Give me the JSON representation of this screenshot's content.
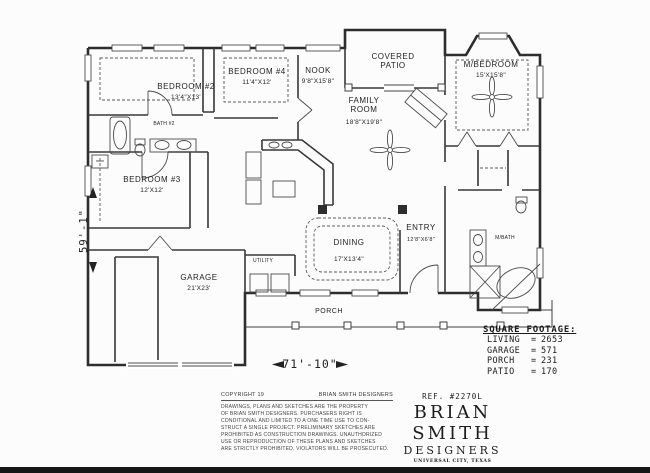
{
  "colors": {
    "paper": "#fcfcfc",
    "line": "#2d2d2d",
    "ink": "#1c1c1c"
  },
  "rooms": {
    "bedroom2": {
      "name": "BEDROOM #2",
      "size": "13'4\"X13'"
    },
    "bedroom4": {
      "name": "BEDROOM #4",
      "size": "11'4\"X12'"
    },
    "nook": {
      "name": "NOOK",
      "size": "9'8\"X15'8\""
    },
    "covered_patio": {
      "name": "COVERED PATIO"
    },
    "m_bedroom": {
      "name": "M/BEDROOM",
      "size": "15'X15'8\""
    },
    "family_room": {
      "name": "FAMILY ROOM",
      "size": "18'8\"X19'8\""
    },
    "bedroom3": {
      "name": "BEDROOM #3",
      "size": "12'X12'"
    },
    "dining": {
      "name": "DINING",
      "size": "17'X13'4\""
    },
    "entry": {
      "name": "ENTRY",
      "size": "12'8\"X6'8\""
    },
    "garage": {
      "name": "GARAGE",
      "size": "21'X23'"
    },
    "porch": {
      "name": "PORCH"
    },
    "m_bath": {
      "name": "M/BATH"
    },
    "bath2": {
      "name": "BATH #2"
    },
    "utility": {
      "name": "UTILITY"
    }
  },
  "dimensions": {
    "overall_width": "71'-10\"",
    "overall_height": "59'-1\""
  },
  "square_footage": {
    "title": "SQUARE FOOTAGE:",
    "eq": "=",
    "rows": [
      {
        "label": "LIVING",
        "value": "2653"
      },
      {
        "label": "GARAGE",
        "value": "571"
      },
      {
        "label": "PORCH",
        "value": "231"
      },
      {
        "label": "PATIO",
        "value": "170"
      }
    ]
  },
  "copyright": {
    "prefix": "COPYRIGHT 19",
    "owner": "BRIAN SMITH DESIGNERS",
    "lines": [
      "DRAWINGS, PLANS AND SKETCHES ARE THE PROPERTY",
      "OF BRIAN SMITH DESIGNERS.  PURCHASERS RIGHT IS",
      "CONDITIONAL AND LIMITED TO A ONE TIME USE TO CON-",
      "STRUCT A SINGLE PROJECT.  PRELIMINARY SKETCHES ARE",
      "PROHIBITED AS CONSTRUCTION DRAWINGS.  UNAUTHORIZED",
      "USE OR REPRODUCTION OF THESE PLANS AND SKETCHES",
      "ARE STRICTLY PROHIBITED.  VIOLATORS WILL BE PROSECUTED."
    ]
  },
  "title_block": {
    "ref": "REF.  #2270L",
    "name": "BRIAN  SMITH",
    "subtitle": "DESIGNERS",
    "location": "UNIVERSAL CITY, TEXAS",
    "phone": "(210)658-9726"
  }
}
